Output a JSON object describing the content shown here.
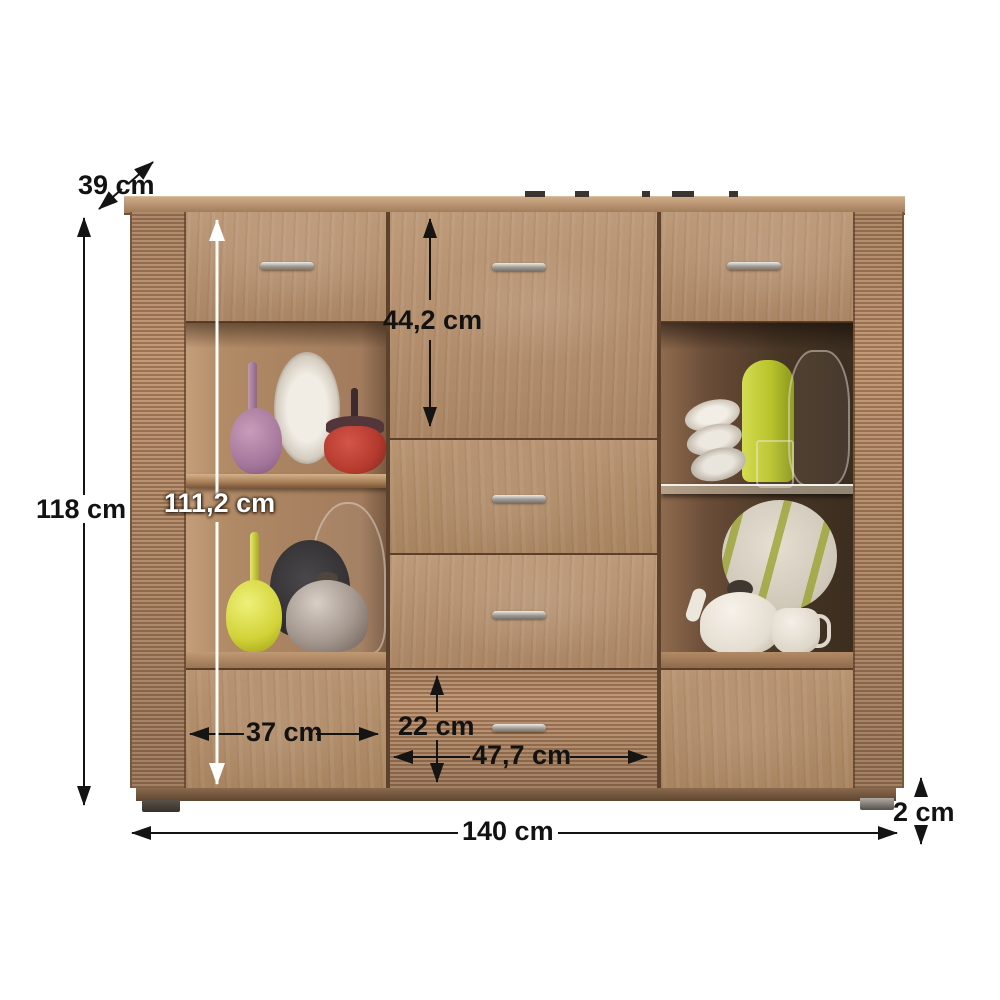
{
  "diagram": {
    "unit": "cm",
    "labels": {
      "depth": "39 cm",
      "total_height": "118 cm",
      "inner_height": "111,2 cm",
      "top_drawer_height": "44,2 cm",
      "door_width": "37 cm",
      "bottom_drawer_height": "22 cm",
      "center_width": "47,7 cm",
      "total_width": "140 cm",
      "foot_height": "2 cm"
    },
    "colors": {
      "background": "#ffffff",
      "wood_light": "#bd9a79",
      "wood_mid": "#aa8564",
      "wood_dark": "#6b4c34",
      "rib_light": "#c29a78",
      "rib_dark": "#9d7454",
      "plinth": "#6f5138",
      "arrow": "#141414",
      "arrow_inner": "#ffffff"
    }
  }
}
